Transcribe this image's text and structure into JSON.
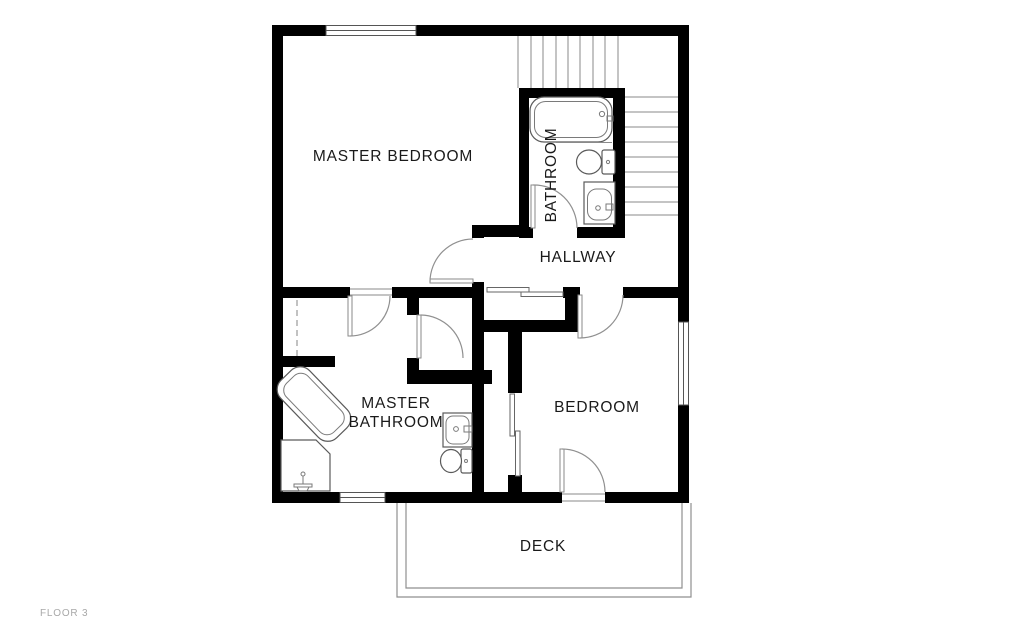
{
  "plan": {
    "floor_label": "FLOOR 3",
    "rooms": {
      "master_bedroom": "MASTER BEDROOM",
      "bathroom": "BATHROOM",
      "hallway": "HALLWAY",
      "master_bathroom_line1": "MASTER",
      "master_bathroom_line2": "BATHROOM",
      "bedroom": "BEDROOM",
      "deck": "DECK"
    },
    "colors": {
      "wall": "#000000",
      "thin_line": "#8a8a8a",
      "label_text": "#1a1a1a",
      "floor_label_text": "#a8a8a8",
      "background": "#ffffff"
    }
  }
}
